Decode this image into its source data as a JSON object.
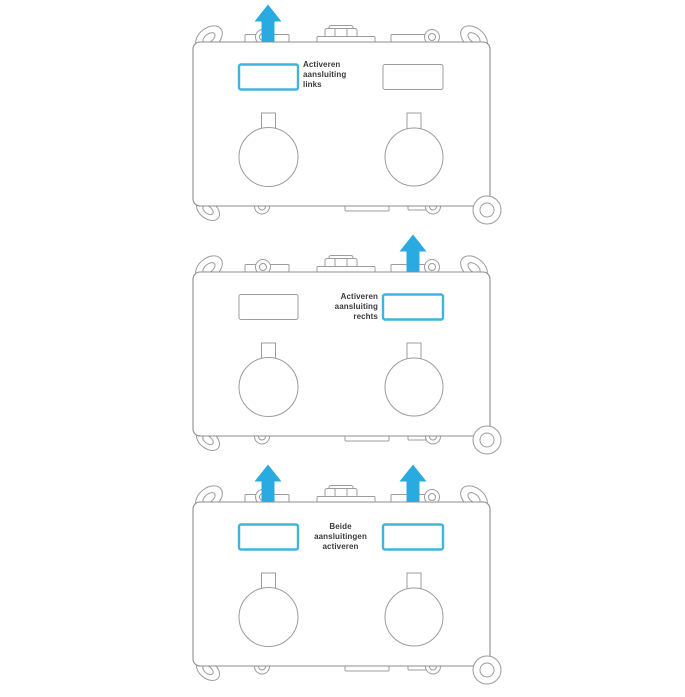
{
  "colors": {
    "background": "#ffffff",
    "accent_blue": "#29ABE2",
    "highlight_stroke": "#40B4DE",
    "outline_gray": "#9C9C9C",
    "body_outline_gray": "#8E8E8E",
    "text_dark": "#3A3A3A"
  },
  "icons": {
    "flow_arrow": {
      "name": "up-arrow-icon",
      "shape": "filled-upward-arrow",
      "color": "#29ABE2"
    }
  },
  "diagrams": [
    {
      "id": "activate-left",
      "label": {
        "lines": [
          "Activeren",
          "aansluiting",
          "links"
        ],
        "text": "Activeren aansluiting links",
        "align": "left"
      },
      "highlighted_slot": "left",
      "arrows": [
        "left"
      ]
    },
    {
      "id": "activate-right",
      "label": {
        "lines": [
          "Activeren",
          "aansluiting",
          "rechts"
        ],
        "text": "Activeren aansluiting rechts",
        "align": "right"
      },
      "highlighted_slot": "right",
      "arrows": [
        "right"
      ]
    },
    {
      "id": "activate-both",
      "label": {
        "lines": [
          "Beide",
          "aansluitingen",
          "activeren"
        ],
        "text": "Beide aansluitingen activeren",
        "align": "center"
      },
      "highlighted_slot": "both",
      "arrows": [
        "left",
        "right"
      ]
    }
  ]
}
